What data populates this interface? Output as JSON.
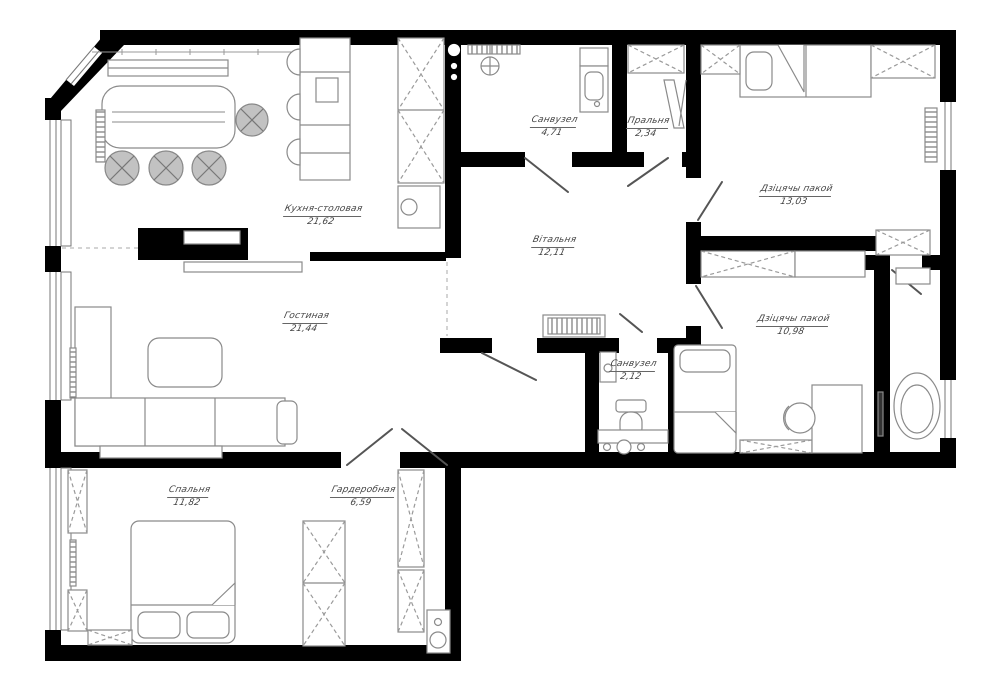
{
  "plan": {
    "type": "apartment-floor-plan",
    "rooms": [
      {
        "id": "kitchen-dining",
        "name": "Кухня-столовая",
        "area": "21,62"
      },
      {
        "id": "living-room",
        "name": "Гостиная",
        "area": "21,44"
      },
      {
        "id": "bedroom",
        "name": "Спальня",
        "area": "11,82"
      },
      {
        "id": "wardrobe",
        "name": "Гардеробная",
        "area": "6,59"
      },
      {
        "id": "bathroom-main",
        "name": "Санвузел",
        "area": "4,71"
      },
      {
        "id": "laundry",
        "name": "Пральня",
        "area": "2,34"
      },
      {
        "id": "hall",
        "name": "Вітальня",
        "area": "12,11"
      },
      {
        "id": "kids-room-1",
        "name": "Дзіцячы пакой",
        "area": "13,03"
      },
      {
        "id": "kids-room-2",
        "name": "Дзіцячы пакой",
        "area": "10,98"
      },
      {
        "id": "bathroom-small",
        "name": "Санвузел",
        "area": "2,12"
      }
    ],
    "colors": {
      "wall": "#000000",
      "furniture_line": "#8a8a8a",
      "hatch_line": "#9a9a9a",
      "stool_fill": "#c2c2c2",
      "label_text": "#444444",
      "background": "#ffffff"
    }
  }
}
